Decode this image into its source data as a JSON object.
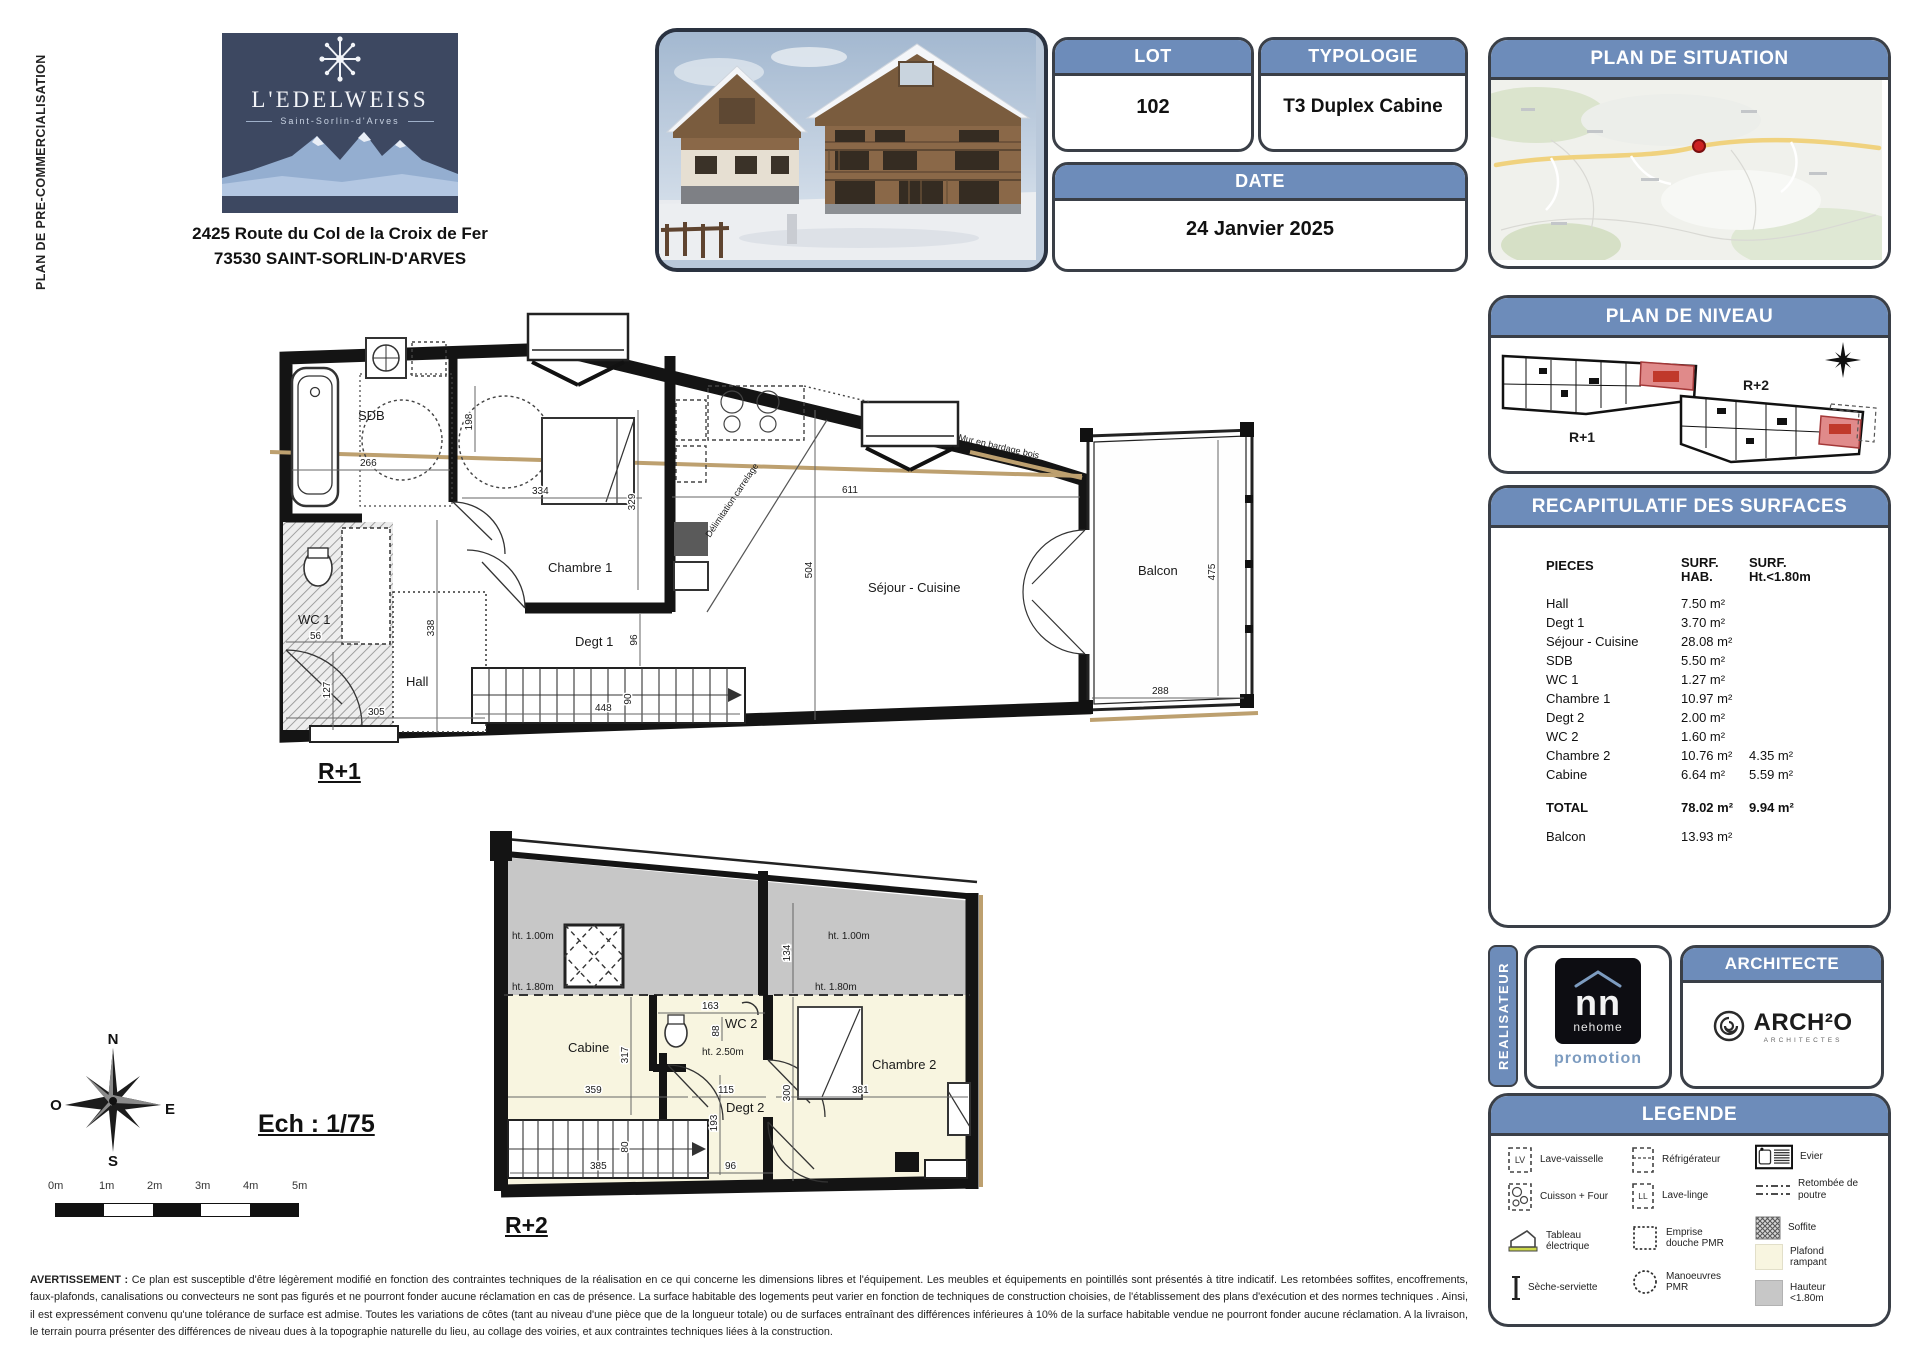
{
  "page": {
    "side_label": "PLAN DE PRE-COMMERCIALISATION",
    "project": {
      "name": "L'EDELWEISS",
      "location": "Saint-Sorlin-d'Arves",
      "address1": "2425 Route du Col de la Croix de Fer",
      "address2": "73530 SAINT-SORLIN-D'ARVES"
    }
  },
  "info": {
    "lot_label": "LOT",
    "lot_value": "102",
    "typologie_label": "TYPOLOGIE",
    "typologie_value": "T3 Duplex Cabine",
    "date_label": "DATE",
    "date_value": "24 Janvier 2025"
  },
  "situation": {
    "title": "PLAN DE SITUATION"
  },
  "niveau": {
    "title": "PLAN DE NIVEAU",
    "r1": "R+1",
    "r2": "R+2"
  },
  "surfaces": {
    "title": "RECAPITULATIF DES SURFACES",
    "col_pieces": "PIECES",
    "col_hab1": "SURF.",
    "col_hab2": "HAB.",
    "col_ht1": "SURF.",
    "col_ht2": "Ht.<1.80m",
    "rows": [
      {
        "name": "Hall",
        "hab": "7.50 m²",
        "ht": ""
      },
      {
        "name": "Degt 1",
        "hab": "3.70 m²",
        "ht": ""
      },
      {
        "name": "Séjour - Cuisine",
        "hab": "28.08 m²",
        "ht": ""
      },
      {
        "name": "SDB",
        "hab": "5.50 m²",
        "ht": ""
      },
      {
        "name": "WC 1",
        "hab": "1.27 m²",
        "ht": ""
      },
      {
        "name": "Chambre 1",
        "hab": "10.97 m²",
        "ht": ""
      },
      {
        "name": "Degt 2",
        "hab": "2.00 m²",
        "ht": ""
      },
      {
        "name": "WC 2",
        "hab": "1.60 m²",
        "ht": ""
      },
      {
        "name": "Chambre 2",
        "hab": "10.76 m²",
        "ht": "4.35 m²"
      },
      {
        "name": "Cabine",
        "hab": "6.64 m²",
        "ht": "5.59 m²"
      }
    ],
    "total_label": "TOTAL",
    "total_hab": "78.02 m²",
    "total_ht": "9.94 m²",
    "balcon_label": "Balcon",
    "balcon_hab": "13.93 m²"
  },
  "realisateur": {
    "label": "REALISATEUR",
    "nn": "nn",
    "brand": "nehome",
    "sub": "promotion"
  },
  "architecte": {
    "title": "ARCHITECTE",
    "brand": "ARCH²O",
    "sub": "ARCHITECTES"
  },
  "legende": {
    "title": "LEGENDE",
    "lv_tag": "LV",
    "ll_tag": "LL",
    "lave_vaisselle": "Lave-vaisselle",
    "cuisson": "Cuisson + Four",
    "tableau": "Tableau électrique",
    "seche": "Sèche-serviette",
    "refrigerateur": "Réfrigérateur",
    "lave_linge": "Lave-linge",
    "emprise": "Emprise douche PMR",
    "manoeuvres": "Manoeuvres PMR",
    "evier": "Evier",
    "retombee": "Retombée de poutre",
    "soffite": "Soffite",
    "plafond": "Plafond rampant",
    "hauteur": "Hauteur <1.80m"
  },
  "plan_r1": {
    "label": "R+1",
    "rooms": {
      "sdb": "SDB",
      "wc1": "WC 1",
      "hall": "Hall",
      "ch1": "Chambre 1",
      "degt1": "Degt 1",
      "sejour": "Séjour - Cuisine",
      "balcon": "Balcon"
    },
    "notes": {
      "bardage": "Mur en bardage bois",
      "carrelage": "Délimitation carrelage"
    },
    "dims": {
      "sdb_w": "266",
      "sdb_h": "198",
      "ch1_w": "334",
      "ch1_h": "329",
      "sej_w": "611",
      "sej_h": "504",
      "left_h": "338",
      "degt_h": "96",
      "stair_l": "448",
      "stair_w": "90",
      "hall_w": "305",
      "wc_w": "56",
      "wc_h": "127",
      "balc_h": "475",
      "balc_w": "288"
    }
  },
  "plan_r2": {
    "label": "R+2",
    "rooms": {
      "cabine": "Cabine",
      "wc2": "WC 2",
      "degt2": "Degt 2",
      "ch2": "Chambre 2"
    },
    "heights": {
      "h100": "ht. 1.00m",
      "h180": "ht. 1.80m",
      "h250": "ht. 2.50m"
    },
    "dims": {
      "cab_h": "317",
      "wc_w": "163",
      "wc_h": "88",
      "gray_h": "134",
      "cab_w": "359",
      "degt_w": "115",
      "ch2_h": "300",
      "ch2_w": "381",
      "degt_h": "193",
      "stair_l": "385",
      "bot_w": "96",
      "stair_w": "80"
    }
  },
  "scalebar": {
    "label": "Ech : 1/75",
    "ticks": [
      "0m",
      "1m",
      "2m",
      "3m",
      "4m",
      "5m"
    ]
  },
  "compass": {
    "n": "N",
    "s": "S",
    "e": "E",
    "o": "O"
  },
  "disclaimer": {
    "lead": "AVERTISSEMENT :",
    "body": "Ce plan est susceptible d'être légèrement modifié en fonction des contraintes techniques de la réalisation en ce qui concerne les dimensions libres et l'équipement. Les meubles et équipements en pointillés sont présentés à titre indicatif. Les retombées soffites, encoffrements, faux-plafonds, canalisations ou convecteurs ne sont pas figurés et ne pourront fonder aucune réclamation en cas de présence. La surface habitable des logements peut varier en fonction de techniques de construction choisies, de l'établissement des plans d'exécution et des normes techniques . Ainsi, il est expressément convenu qu'une tolérance de surface est admise. Toutes les variations de côtes (tant au niveau d'une pièce que de la longueur totale) ou de surfaces entraînant des différences inférieures à 10% de la surface habitable vendue ne pourront fonder aucune réclamation. A la livraison, le terrain pourra présenter des différences de niveau dues à la topographie naturelle du lieu, au collage des voiries, et aux contraintes techniques liées à la construction."
  }
}
